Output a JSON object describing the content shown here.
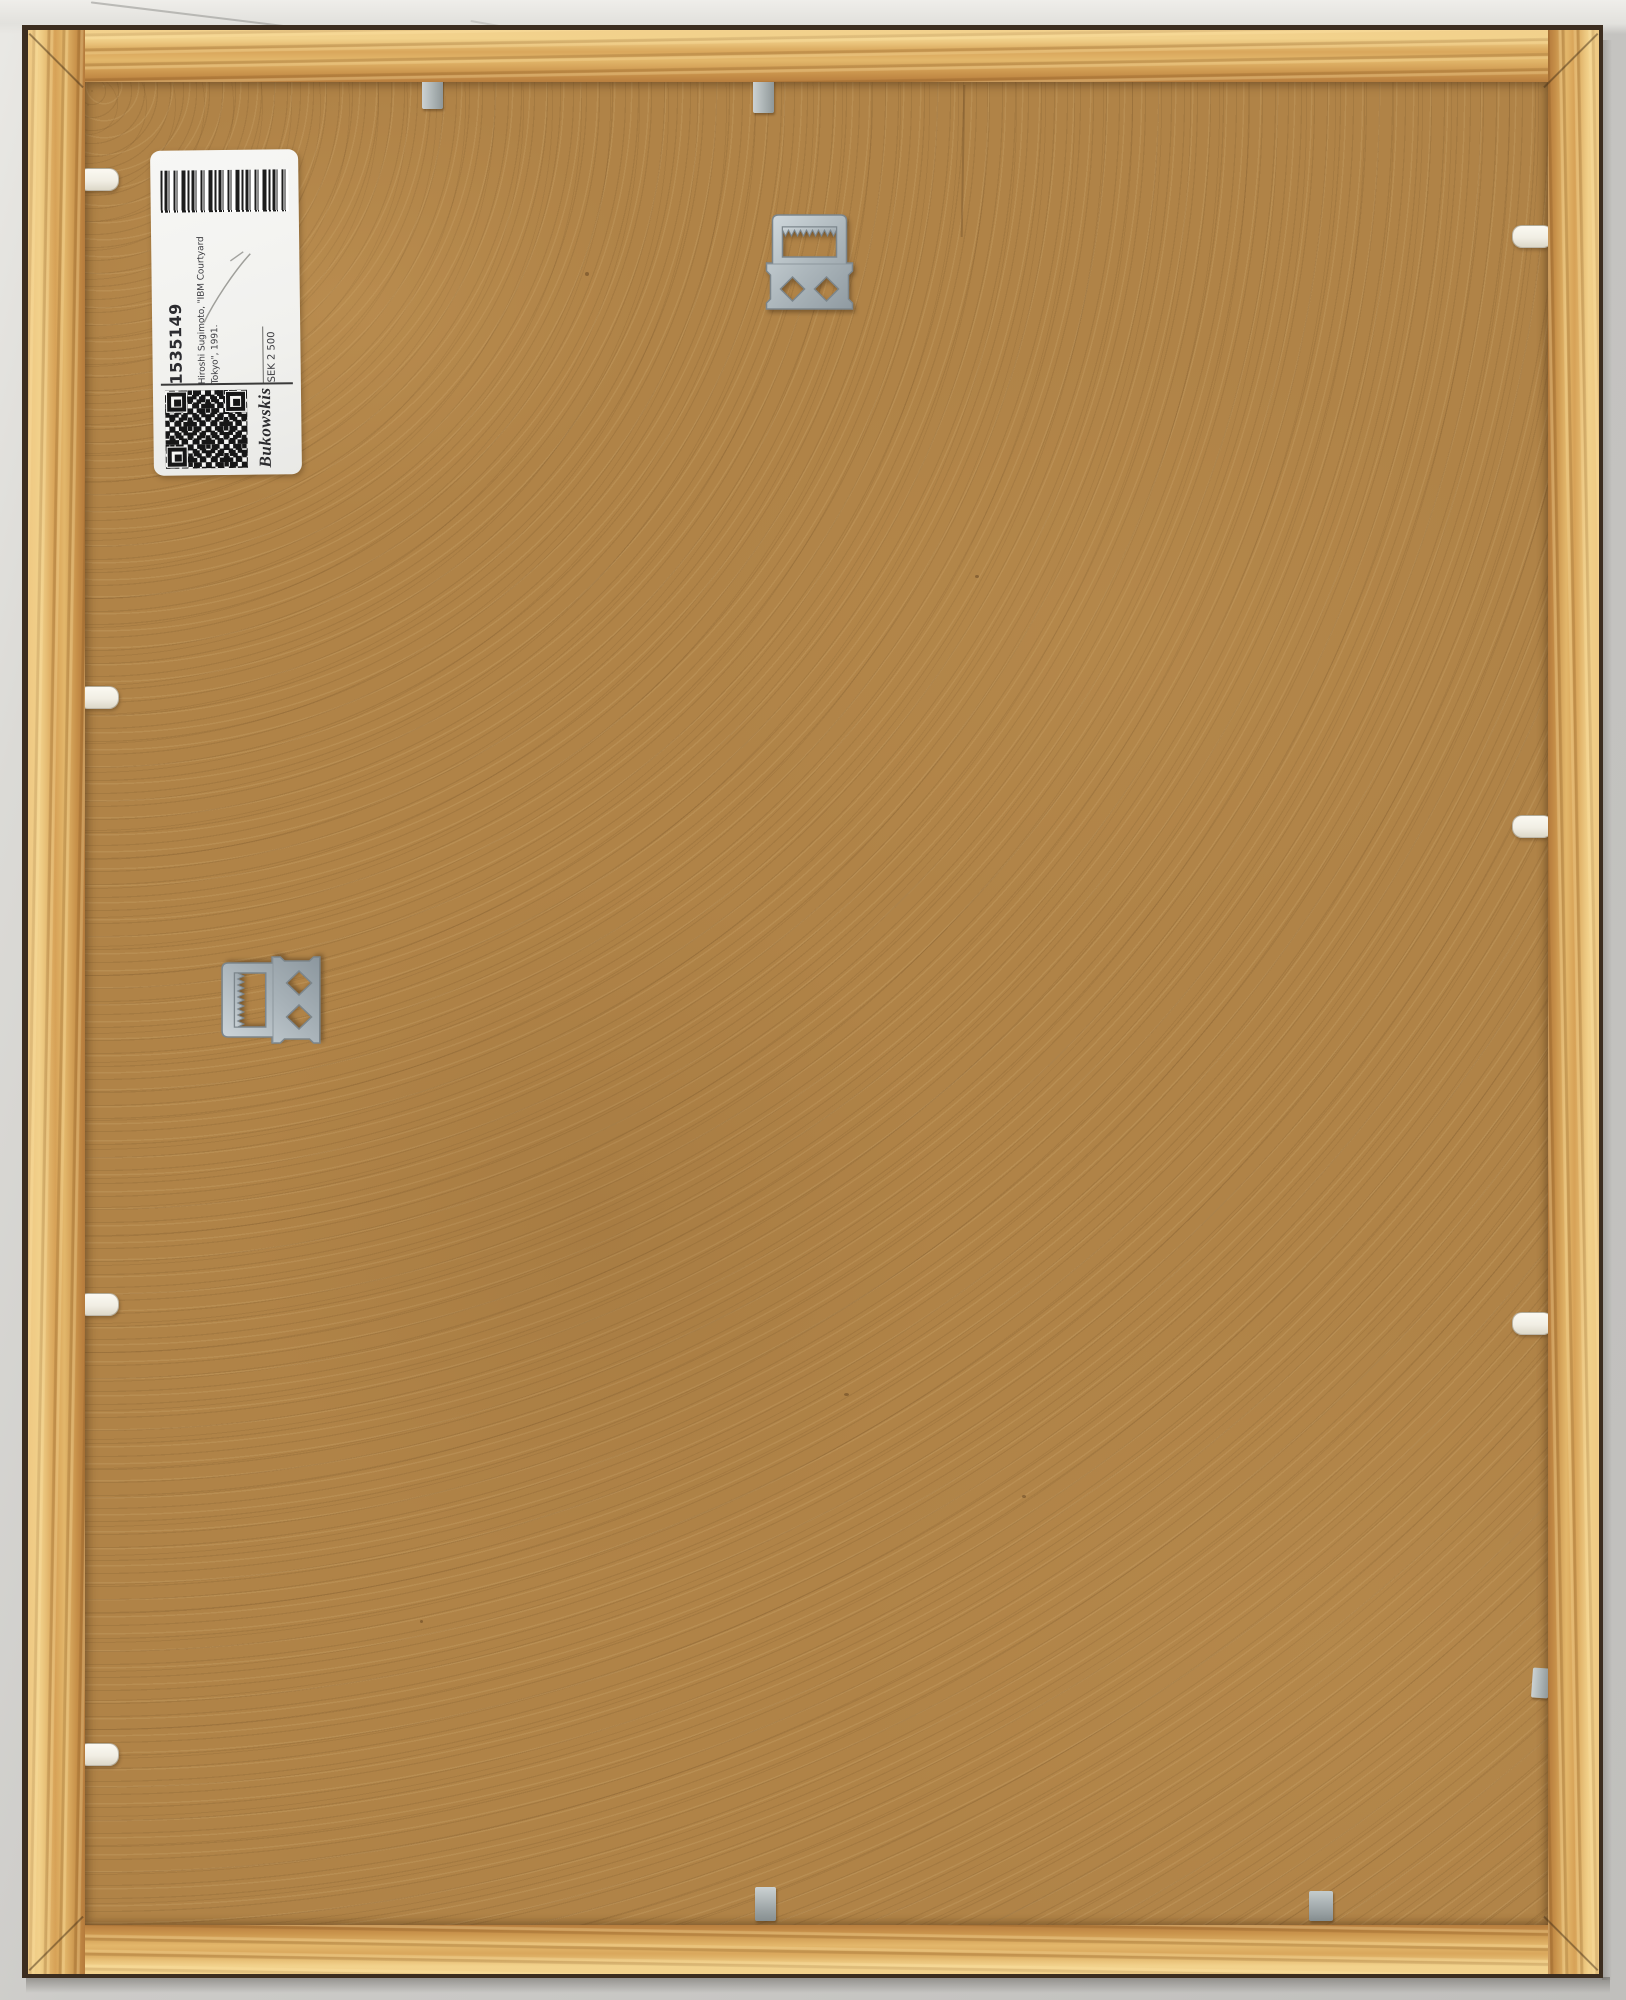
{
  "label": {
    "lot_number": "1535149",
    "artwork_line1": "Hiroshi Sugimoto, \"IBM Courtyard",
    "artwork_line2": "Tokyo\", 1991.",
    "price": "SEK 2 500",
    "brand": "Bukowskis"
  },
  "hardware": {
    "hangers": [
      "sawtooth-hanger-top-center",
      "sawtooth-hanger-left-middle"
    ],
    "white_tabs_left": 4,
    "white_tabs_right": 3,
    "metal_clips_top": 2,
    "metal_clips_bottom": 2,
    "metal_clips_right": 1
  },
  "colors": {
    "frame_wood": "#d9a75c",
    "backing_board": "#b08347",
    "wall": "#c8c7c4",
    "label_background": "#f3f2ee",
    "hardware_metal": "#aeb8bd",
    "barcode_ink": "#1d1d1d"
  }
}
